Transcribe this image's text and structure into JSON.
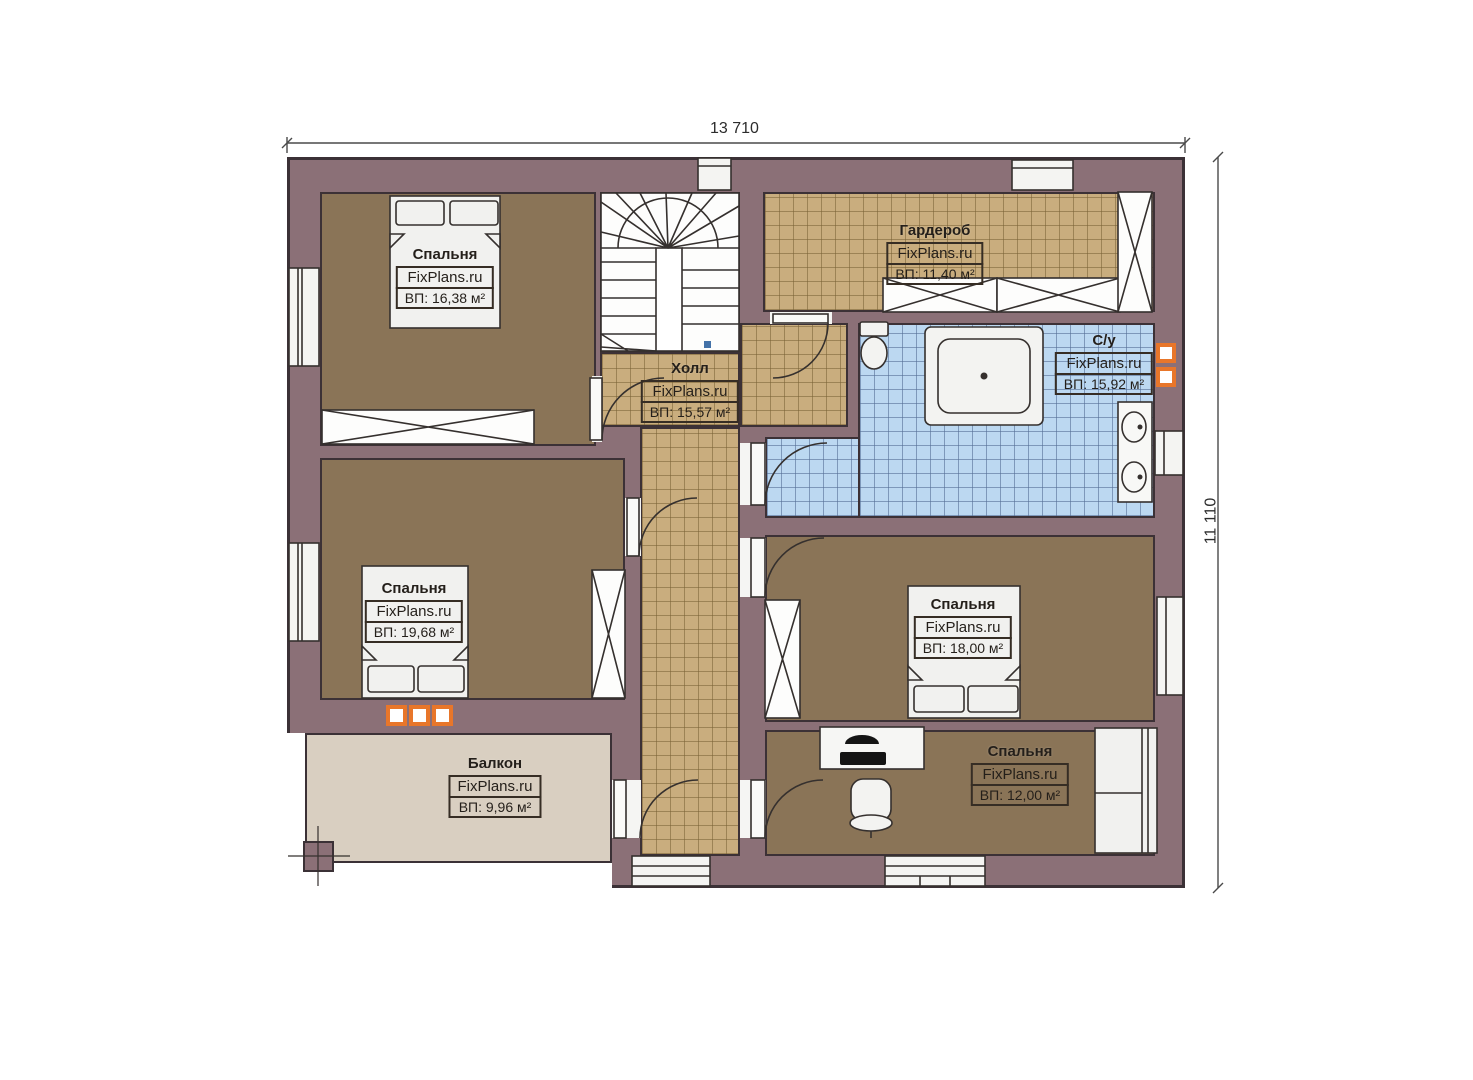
{
  "plan": {
    "watermark": "FixPlans.ru",
    "dimensions": {
      "width_label": "13 710",
      "height_label": "11 110"
    },
    "rooms": [
      {
        "name": "Спальня",
        "area": "ВП: 16,38 м²"
      },
      {
        "name": "Гардероб",
        "area": "ВП: 11,40 м²"
      },
      {
        "name": "С/у",
        "area": "ВП: 15,92 м²"
      },
      {
        "name": "Холл",
        "area": "ВП: 15,57 м²"
      },
      {
        "name": "Спальня",
        "area": "ВП: 19,68 м²"
      },
      {
        "name": "Спальня",
        "area": "ВП: 18,00 м²"
      },
      {
        "name": "Спальня",
        "area": "ВП: 12,00 м²"
      },
      {
        "name": "Балкон",
        "area": "ВП: 9,96 м²"
      }
    ],
    "colors": {
      "wall": "#8b7077",
      "floor_dark": "#8a7457",
      "tile_tan": "#c9ad7e",
      "tile_blue": "#bcd8f1",
      "balcony": "#d9cfc1",
      "accent_orange": "#e8762a"
    }
  }
}
